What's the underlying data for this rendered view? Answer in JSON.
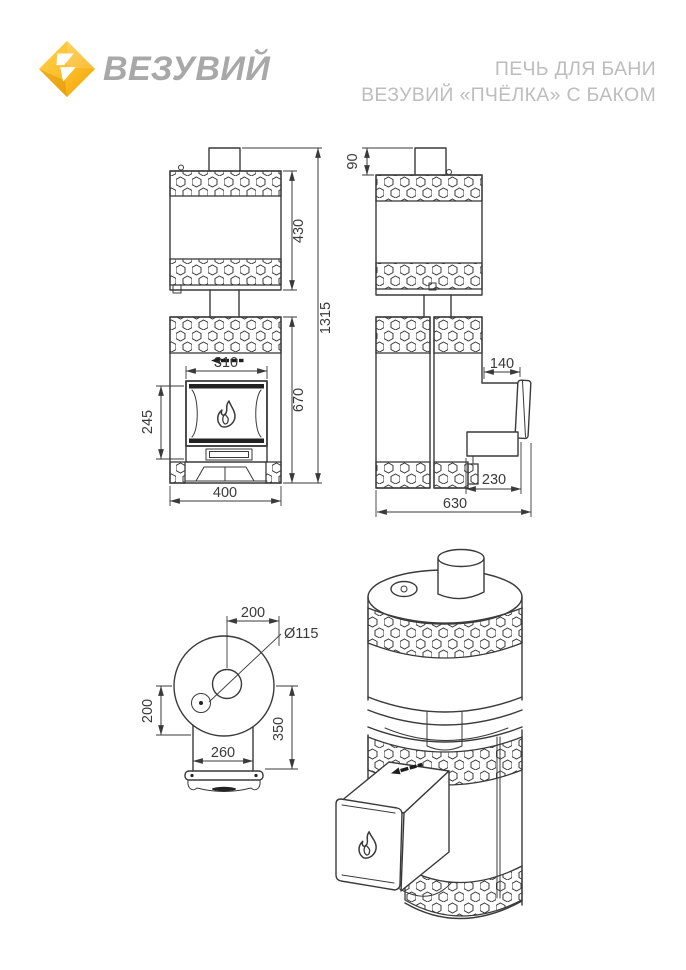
{
  "header": {
    "brand": "ВЕЗУВИЙ",
    "title_line1": "ПЕЧЬ ДЛЯ БАНИ",
    "title_line2": "ВЕЗУВИЙ «ПЧЁЛКА» С БАКОМ"
  },
  "colors": {
    "line": "#3a3a3a",
    "title_gray": "#bdbdbd",
    "brand_gray": "#a8a8a8",
    "logo_yellow_light": "#ffd34d",
    "logo_yellow": "#fdbe2c",
    "logo_orange": "#f2a400"
  },
  "icons": [
    "vesuvius-diamond-logo",
    "flame-icon",
    "damper-handle-icon"
  ],
  "views": {
    "front": {
      "dims": {
        "tank_height": "430",
        "total_height": "1315",
        "body_height": "670",
        "door_width": "310",
        "door_height": "245",
        "base_width": "400"
      }
    },
    "side": {
      "dims": {
        "chimney_stub_height": "90",
        "tunnel_top": "140",
        "tunnel_depth": "230",
        "total_depth": "630"
      }
    },
    "top": {
      "dims": {
        "chimney_offset": "200",
        "chimney_diameter": "Ø115",
        "axis_offset": "200",
        "tunnel_length": "350",
        "tunnel_width": "260"
      }
    }
  }
}
